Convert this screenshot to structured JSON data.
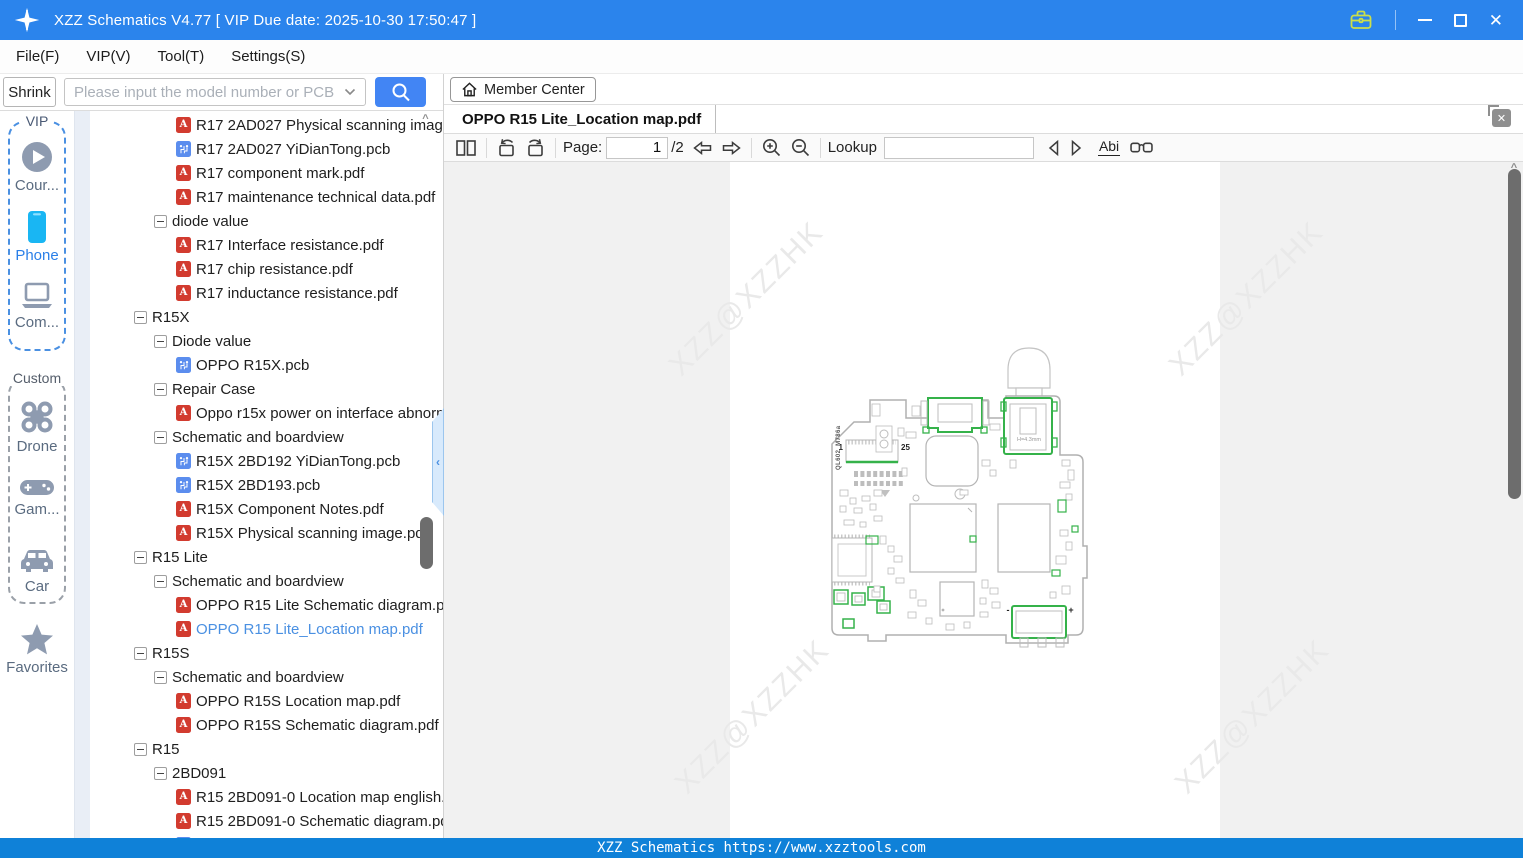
{
  "titlebar": {
    "title": "XZZ Schematics V4.77 [ VIP Due date: 2025-10-30 17:50:47 ]"
  },
  "menu": {
    "items": [
      {
        "label": "File(F)"
      },
      {
        "label": "VIP(V)"
      },
      {
        "label": "Tool(T)"
      },
      {
        "label": "Settings(S)"
      }
    ]
  },
  "search": {
    "shrink_label": "Shrink",
    "placeholder": "Please input the model number or PCB"
  },
  "member_center": {
    "label": "Member Center"
  },
  "sidebar": {
    "vip": {
      "label": "VIP",
      "items": [
        {
          "label": "Cour..."
        },
        {
          "label": "Phone"
        },
        {
          "label": "Com..."
        }
      ]
    },
    "custom": {
      "label": "Custom",
      "items": [
        {
          "label": "Drone"
        },
        {
          "label": "Gam..."
        },
        {
          "label": "Car"
        }
      ]
    },
    "favorites_label": "Favorites"
  },
  "tree": {
    "items": [
      {
        "icon": "pdf",
        "indent": 3,
        "label": "R17 2AD027 Physical scanning image.pdf"
      },
      {
        "icon": "pcb",
        "indent": 3,
        "label": "R17 2AD027 YiDianTong.pcb"
      },
      {
        "icon": "pdf",
        "indent": 3,
        "label": "R17 component mark.pdf"
      },
      {
        "icon": "pdf",
        "indent": 3,
        "label": "R17 maintenance technical data.pdf"
      },
      {
        "icon": "minus",
        "indent": 2,
        "label": "diode value"
      },
      {
        "icon": "pdf",
        "indent": 3,
        "label": "R17 Interface resistance.pdf"
      },
      {
        "icon": "pdf",
        "indent": 3,
        "label": "R17 chip resistance.pdf"
      },
      {
        "icon": "pdf",
        "indent": 3,
        "label": "R17 inductance resistance.pdf"
      },
      {
        "icon": "minus",
        "indent": 1,
        "label": "R15X"
      },
      {
        "icon": "minus",
        "indent": 2,
        "label": "Diode value"
      },
      {
        "icon": "pcb",
        "indent": 3,
        "label": "OPPO R15X.pcb"
      },
      {
        "icon": "minus",
        "indent": 2,
        "label": "Repair Case"
      },
      {
        "icon": "pdf",
        "indent": 3,
        "label": "Oppo r15x power on interface abnormal.pdf"
      },
      {
        "icon": "minus",
        "indent": 2,
        "label": "Schematic and boardview"
      },
      {
        "icon": "pcb",
        "indent": 3,
        "label": "R15X 2BD192 YiDianTong.pcb"
      },
      {
        "icon": "pcb",
        "indent": 3,
        "label": "R15X 2BD193.pcb"
      },
      {
        "icon": "pdf",
        "indent": 3,
        "label": "R15X Component Notes.pdf"
      },
      {
        "icon": "pdf",
        "indent": 3,
        "label": "R15X Physical scanning image.pdf"
      },
      {
        "icon": "minus",
        "indent": 1,
        "label": "R15 Lite"
      },
      {
        "icon": "minus",
        "indent": 2,
        "label": "Schematic and boardview"
      },
      {
        "icon": "pdf",
        "indent": 3,
        "label": "OPPO R15 Lite Schematic diagram.pdf"
      },
      {
        "icon": "pdf",
        "indent": 3,
        "label": "OPPO R15 Lite_Location map.pdf",
        "selected": true
      },
      {
        "icon": "minus",
        "indent": 1,
        "label": "R15S"
      },
      {
        "icon": "minus",
        "indent": 2,
        "label": "Schematic and boardview"
      },
      {
        "icon": "pdf",
        "indent": 3,
        "label": "OPPO R15S Location map.pdf"
      },
      {
        "icon": "pdf",
        "indent": 3,
        "label": "OPPO R15S Schematic diagram.pdf"
      },
      {
        "icon": "minus",
        "indent": 1,
        "label": "R15"
      },
      {
        "icon": "minus",
        "indent": 2,
        "label": "2BD091"
      },
      {
        "icon": "pdf",
        "indent": 3,
        "label": "R15 2BD091-0 Location map english.pdf"
      },
      {
        "icon": "pdf",
        "indent": 3,
        "label": "R15 2BD091-0 Schematic diagram.pdf"
      },
      {
        "icon": "pcb",
        "indent": 3,
        "label": "R15 2BD091-0 YiDianTong.pcb"
      }
    ]
  },
  "viewer": {
    "tab_title": "OPPO R15 Lite_Location map.pdf",
    "toolbar": {
      "page_label": "Page:",
      "page_value": "1",
      "page_total": "/2",
      "lookup_label": "Lookup",
      "lookup_value": "",
      "abc_label": "Abi"
    },
    "watermark": "XZZ@XZZHK",
    "board": {
      "silkscreen": "QL602_M786a",
      "pin_first": "1",
      "pin_last": "25",
      "jack_height": "H=4.3mm",
      "battery_minus": "-",
      "battery_plus": "+"
    }
  },
  "statusbar": {
    "text": "XZZ Schematics https://www.xzztools.com"
  },
  "colors": {
    "titlebar": "#2b84ec",
    "accent_blue": "#4285f4",
    "statusbar_blue": "#0f81d8",
    "selected_item": "#4a90e2",
    "pdf_red": "#d23b2f",
    "pcb_blue": "#5b8dee",
    "highlight_green": "#35b24a",
    "briefcase_yellow": "#ccdf4a"
  }
}
